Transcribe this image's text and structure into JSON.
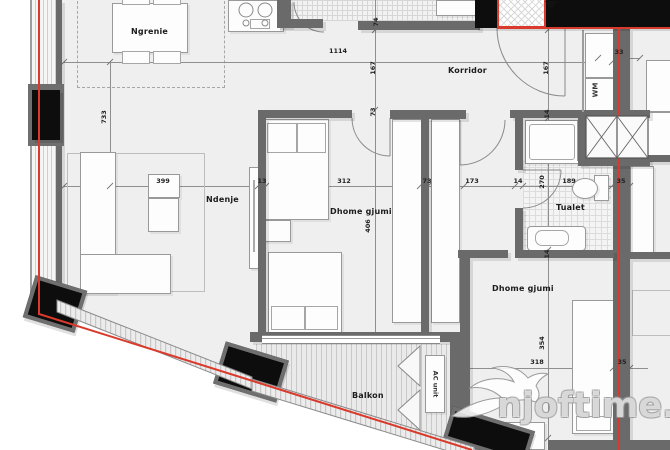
{
  "rooms": {
    "dining": "Ngrenie",
    "corridor": "Korridor",
    "living": "Ndenje",
    "bedroom1": "Dhome gjumi",
    "toilet": "Tualet",
    "bedroom2": "Dhome gjumi",
    "balcony": "Balkon"
  },
  "labels": {
    "ac_unit": "AC unit",
    "washing_machine": "WM"
  },
  "dims": [
    {
      "t": "1114"
    },
    {
      "t": "167"
    },
    {
      "t": "74"
    },
    {
      "t": "73"
    },
    {
      "t": "167"
    },
    {
      "t": "14"
    },
    {
      "t": "33"
    },
    {
      "t": "733"
    },
    {
      "t": "399"
    },
    {
      "t": "13"
    },
    {
      "t": "312"
    },
    {
      "t": "73"
    },
    {
      "t": "173"
    },
    {
      "t": "14"
    },
    {
      "t": "270"
    },
    {
      "t": "189"
    },
    {
      "t": "35"
    },
    {
      "t": "406"
    },
    {
      "t": "354"
    },
    {
      "t": "318"
    },
    {
      "t": "35"
    },
    {
      "t": "14"
    }
  ],
  "watermark": {
    "text": "njoftime.al"
  },
  "colors": {
    "accent_red": "#d93a2b",
    "wall_gray": "#6a6a6a",
    "column_black": "#0d0d0d",
    "floor_gray": "#efefef"
  }
}
